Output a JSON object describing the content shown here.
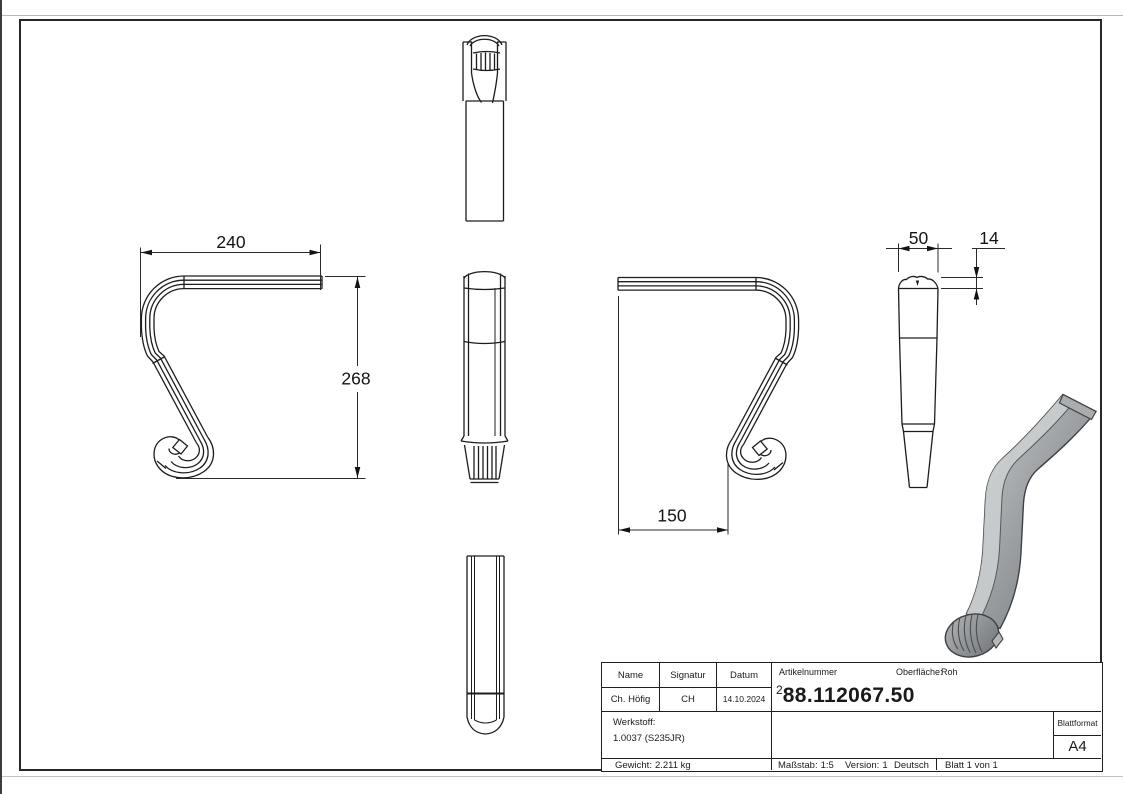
{
  "dimensions": {
    "top_width": "240",
    "overall_height": "268",
    "hook_offset": "150",
    "profile_width": "50",
    "profile_thickness": "14"
  },
  "title_block": {
    "name_label": "Name",
    "signature_label": "Signatur",
    "date_label": "Datum",
    "name_value": "Ch. Höfig",
    "signature_value": "CH",
    "date_value": "14.10.2024",
    "article_label": "Artikelnummer",
    "article_sup": "2",
    "article_number": "88.112067.50",
    "surface_label": "Oberfläche:",
    "surface_value": "Roh",
    "material_label": "Werkstoff:",
    "material_value": "1.0037 (S235JR)",
    "sheet_format_label": "Blattformat",
    "sheet_format_value": "A4",
    "weight_label": "Gewicht:",
    "weight_value": "2.211 kg",
    "scale_label": "Maßstab:",
    "scale_value": "1:5",
    "version_label": "Version:",
    "version_value": "1",
    "language": "Deutsch",
    "sheet_info": "Blatt 1 von 1"
  }
}
